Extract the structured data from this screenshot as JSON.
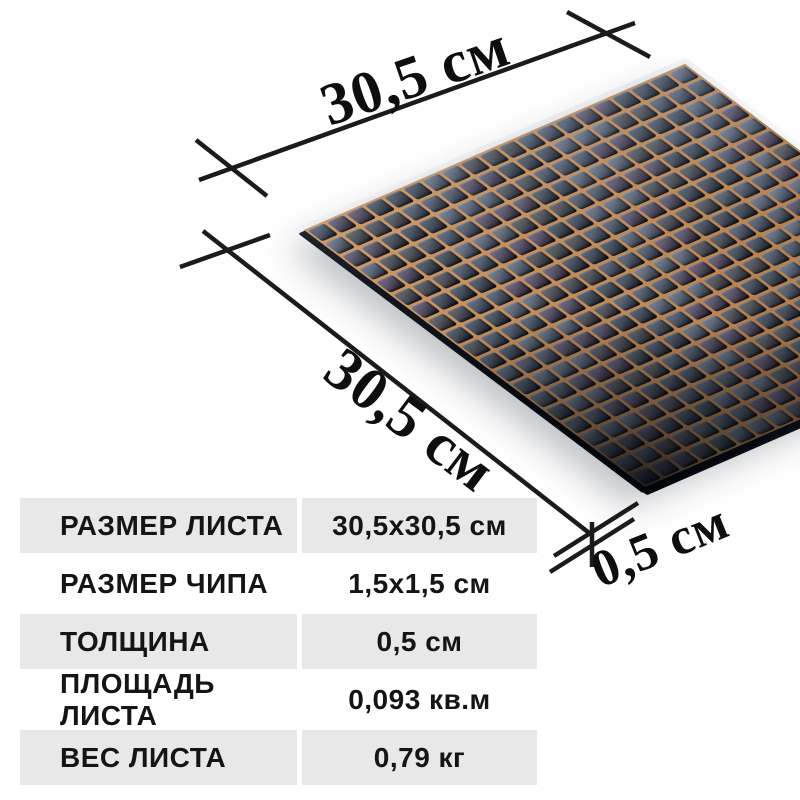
{
  "dimension_labels": {
    "top": "30,5 см",
    "side": "30,5 см",
    "thickness": "0,5 см"
  },
  "spec_table": {
    "rows": [
      {
        "label": "РАЗМЕР ЛИСТА",
        "value": "30,5x30,5 см"
      },
      {
        "label": "РАЗМЕР ЧИПА",
        "value": "1,5x1,5 см"
      },
      {
        "label": "ТОЛЩИНА",
        "value": "0,5 см"
      },
      {
        "label": "ПЛОЩАДЬ ЛИСТА",
        "value": "0,093 кв.м"
      },
      {
        "label": "ВЕС ЛИСТА",
        "value": "0,79 кг"
      }
    ]
  },
  "mosaic": {
    "rows": 20,
    "cols": 20,
    "tile_color": "#565f6f",
    "tile_dark_color": "#131821",
    "backing_color": "#c08a58"
  },
  "colors": {
    "row_stripe": "#e8e8e8",
    "dimension_line": "#1b1b1b",
    "text": "#151515",
    "background": "#ffffff"
  }
}
